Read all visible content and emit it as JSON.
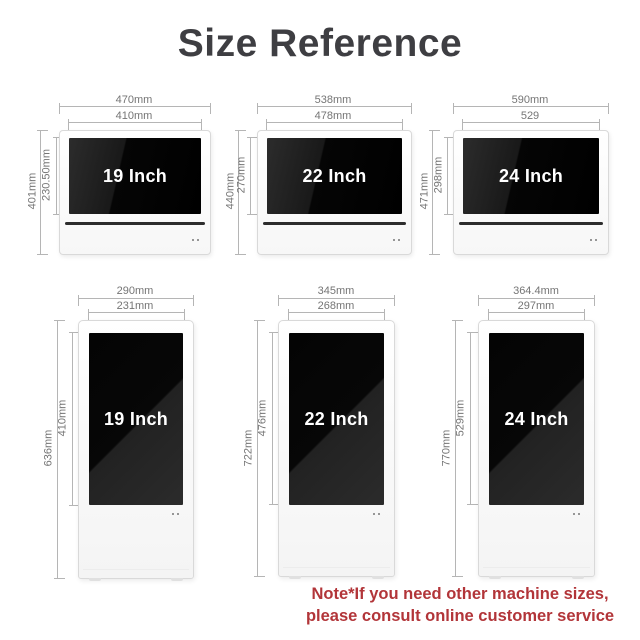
{
  "title": "Size Reference",
  "colors": {
    "title_gray": "#3e3e42",
    "dim_gray": "#757575",
    "note_red": "#b23539",
    "screen_black": "#050505"
  },
  "landscape_monitors": [
    {
      "label": "19 Inch",
      "outer_width": "470mm",
      "screen_width": "410mm",
      "outer_height": "401mm",
      "screen_height": "230.50mm"
    },
    {
      "label": "22 Inch",
      "outer_width": "538mm",
      "screen_width": "478mm",
      "outer_height": "440mm",
      "screen_height": "270mm"
    },
    {
      "label": "24 Inch",
      "outer_width": "590mm",
      "screen_width": "529",
      "outer_height": "471mm",
      "screen_height": "298mm"
    }
  ],
  "portrait_kiosks": [
    {
      "label": "19 Inch",
      "outer_width": "290mm",
      "screen_width": "231mm",
      "outer_height": "636mm",
      "screen_height": "410mm"
    },
    {
      "label": "22 Inch",
      "outer_width": "345mm",
      "screen_width": "268mm",
      "outer_height": "722mm",
      "screen_height": "476mm"
    },
    {
      "label": "24 Inch",
      "outer_width": "364.4mm",
      "screen_width": "297mm",
      "outer_height": "770mm",
      "screen_height": "529mm"
    }
  ],
  "note": {
    "line1": "Note*If you need other machine sizes,",
    "line2": "please consult online customer service"
  }
}
